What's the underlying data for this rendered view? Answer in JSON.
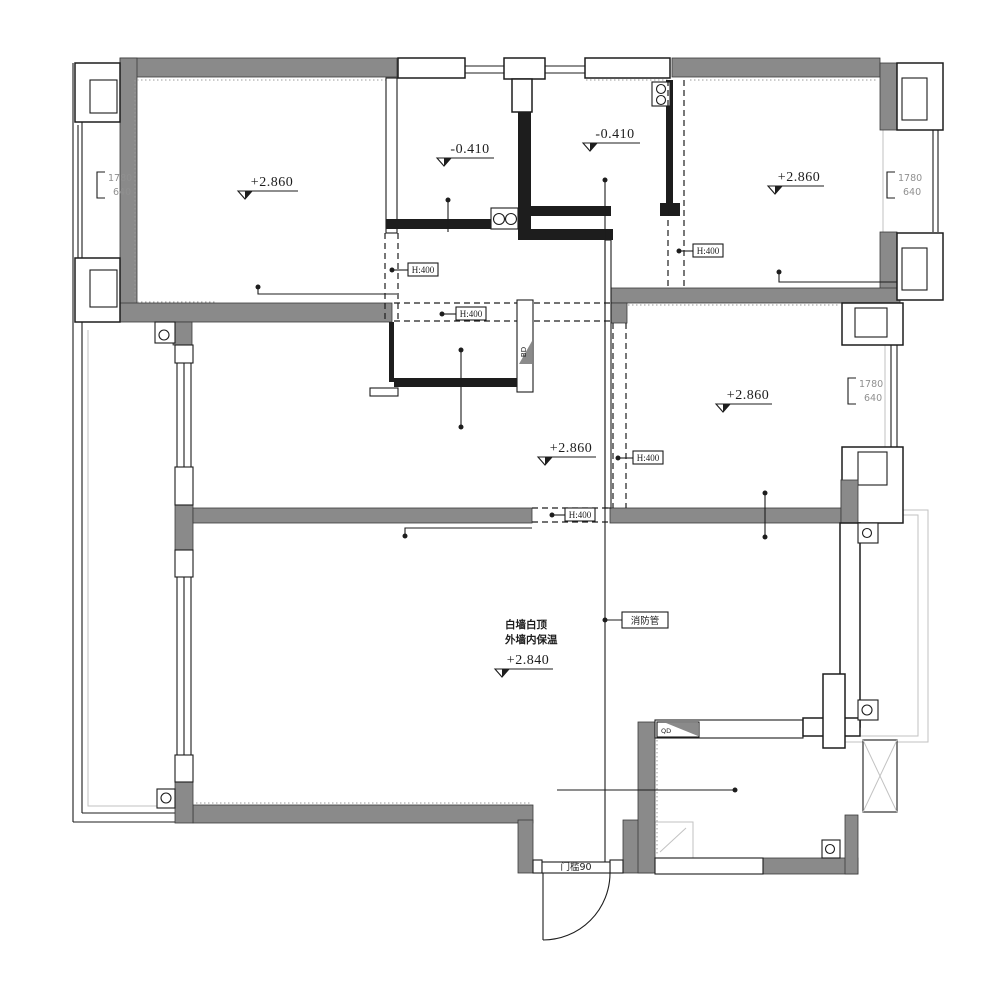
{
  "plan": {
    "elevation_main": "+2.860",
    "elevation_sunken": "-0.410",
    "elevation_living": "+2.840",
    "beam_label": "H:400",
    "window_width": "1780",
    "window_sill": "640",
    "note_line1": "白墙白顶",
    "note_line2": "外墙内保温",
    "fire_pipe_label": "消防管",
    "threshold_label": "门槛90",
    "bd_label": "BD",
    "qd_label": "QD"
  }
}
